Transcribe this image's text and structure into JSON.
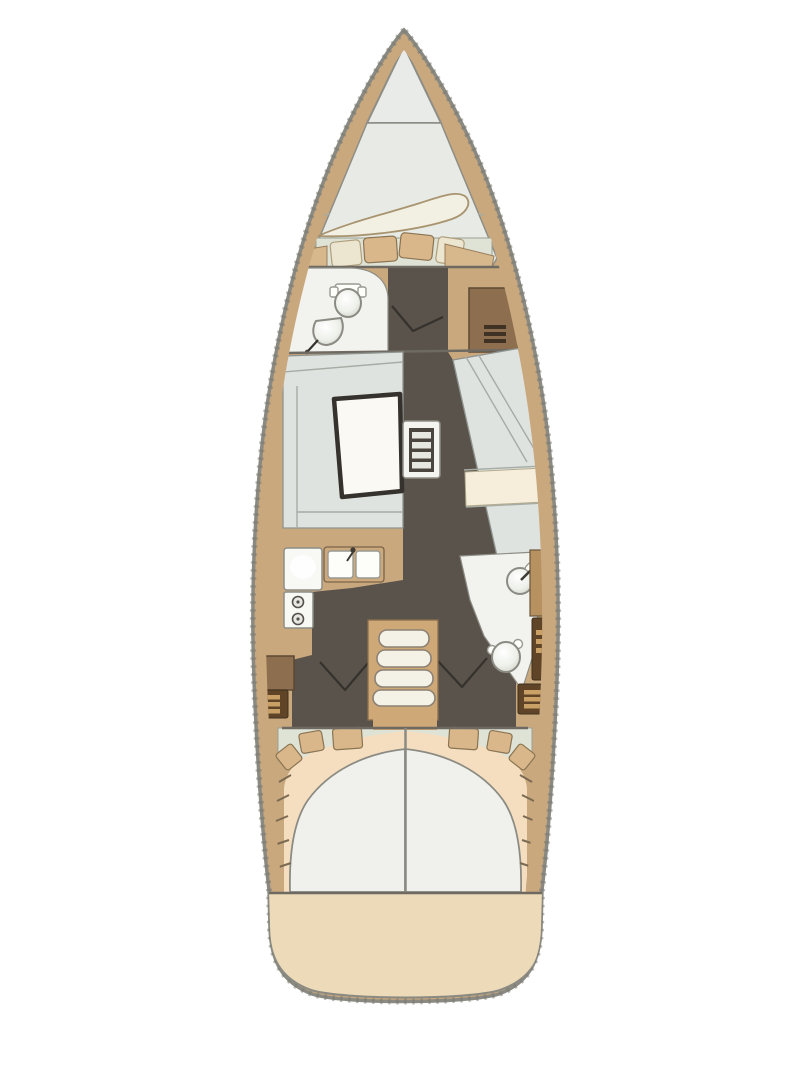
{
  "diagram": {
    "type": "floor-plan",
    "subject": "sailing-yacht-interior-layout",
    "orientation": "bow-up",
    "rooms": [
      "anchor-locker",
      "forward-cabin-v-berth",
      "forward-head",
      "wardrobe",
      "salon-dinette-port",
      "salon-settee-starboard",
      "galley",
      "aft-head",
      "companionway-steps",
      "port-aft-cabin",
      "starboard-aft-cabin",
      "stern-platform"
    ],
    "fixtures": [
      "toilet",
      "washbasin",
      "double-sink",
      "fridge",
      "two-burner-stove",
      "dining-table",
      "double-berth",
      "pillows",
      "duvet",
      "drawer-lockers",
      "steps"
    ]
  },
  "palette": {
    "background": "#ffffff",
    "hull_band": "#c9a87e",
    "tan_light": "#d7b78c",
    "floor_dark": "#59534b",
    "room_white": "#f2f3ef",
    "cabin_light": "#e8ebe5",
    "cushion_gray": "#dfe3e0",
    "floor_strip": "#dfe3d6",
    "bed_white": "#f0f1ec",
    "mattress_peach": "#f4debf",
    "pillow_beige": "#d9b78a",
    "cabinet_brown": "#8d6e4f",
    "shelf_brown": "#b79160",
    "locker_dark": "#5f4428",
    "slat_gold": "#c9a167",
    "stern_beige": "#ecdab8",
    "hull_outline": "#8a8a82",
    "line_dark": "#3f3b35",
    "wall_line": "#6e6a62",
    "blanket_ivory": "#f2efe3",
    "cream_cushion": "#f6eedb",
    "table_white": "#fbf9f3",
    "steps_tan": "#cfa878",
    "tread_white": "#f4f1e6"
  }
}
